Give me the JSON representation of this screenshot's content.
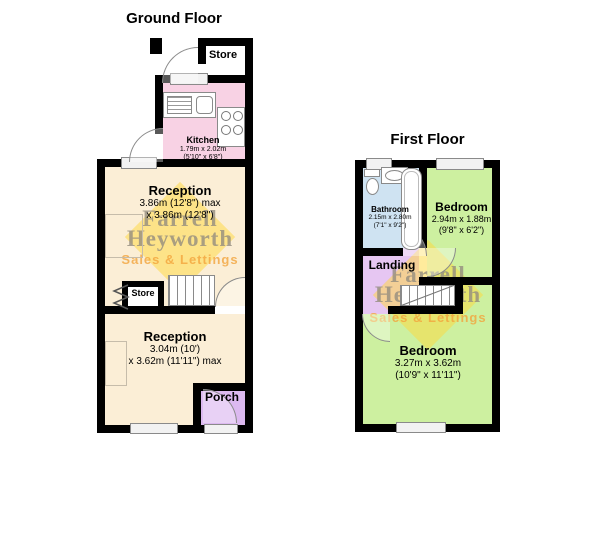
{
  "ground_floor": {
    "title": "Ground Floor",
    "store_top": {
      "label": "Store"
    },
    "kitchen": {
      "label": "Kitchen",
      "dims1": "1.79m x 2.02m",
      "dims2": "(5'10\" x 6'8\")"
    },
    "reception1": {
      "label": "Reception",
      "dims1": "3.86m (12'8\") max",
      "dims2": "x 3.86m (12'8\")"
    },
    "store_understairs": {
      "label": "Store"
    },
    "reception2": {
      "label": "Reception",
      "dims1": "3.04m (10')",
      "dims2": "x 3.62m (11'11\") max"
    },
    "porch": {
      "label": "Porch"
    }
  },
  "first_floor": {
    "title": "First Floor",
    "bathroom": {
      "label": "Bathroom",
      "dims1": "2.15m x 2.80m",
      "dims2": "(7'1\" x 9'2\")"
    },
    "bedroom1": {
      "label": "Bedroom",
      "dims1": "2.94m x 1.88m",
      "dims2": "(9'8\" x 6'2\")"
    },
    "landing": {
      "label": "Landing"
    },
    "bedroom2": {
      "label": "Bedroom",
      "dims1": "3.27m x 3.62m",
      "dims2": "(10'9\" x 11'11\")"
    }
  },
  "watermark": {
    "word1": "Farrell",
    "word2": "Heyworth",
    "tagline": "Sales & Lettings"
  },
  "colors": {
    "wall": "#000000",
    "reception": "#fbeed6",
    "kitchen": "#f8d2e4",
    "porch": "#dcb9f0",
    "landing": "#e6c6f2",
    "bedroom": "#cdf0a0",
    "bathroom": "#cfe3f2",
    "watermark_diamond": "#ffd83a",
    "watermark_text": "#948c7e",
    "watermark_tagline": "#f3a43c"
  }
}
